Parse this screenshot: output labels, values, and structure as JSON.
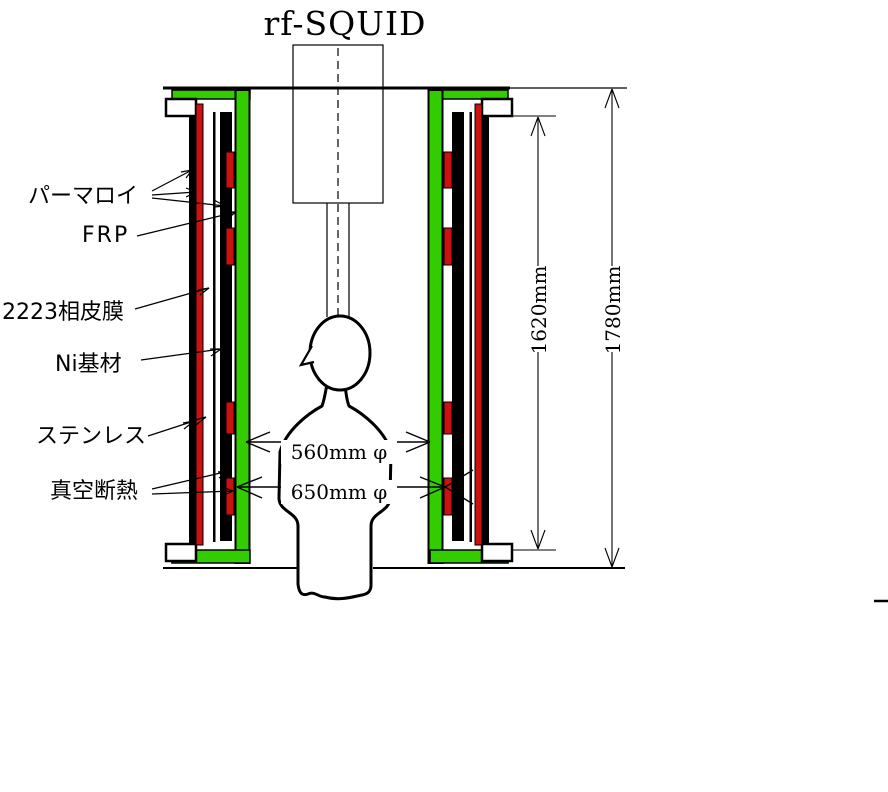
{
  "title": "rf-SQUID",
  "colors": {
    "frp_green": "#33cc00",
    "film_red": "#cc1111",
    "line_black": "#000000",
    "background": "#ffffff"
  },
  "labels": {
    "permalloy": "パーマロイ",
    "frp": "FRP",
    "film2223": "2223相皮膜",
    "ni_substrate": "Ni基材",
    "stainless": "ステンレス",
    "vacuum_insulation": "真空断熱"
  },
  "dimensions": {
    "inner_diameter": "560mm φ",
    "outer_diameter": "650mm φ",
    "inner_height": "1620mm",
    "outer_height": "1780mm"
  }
}
